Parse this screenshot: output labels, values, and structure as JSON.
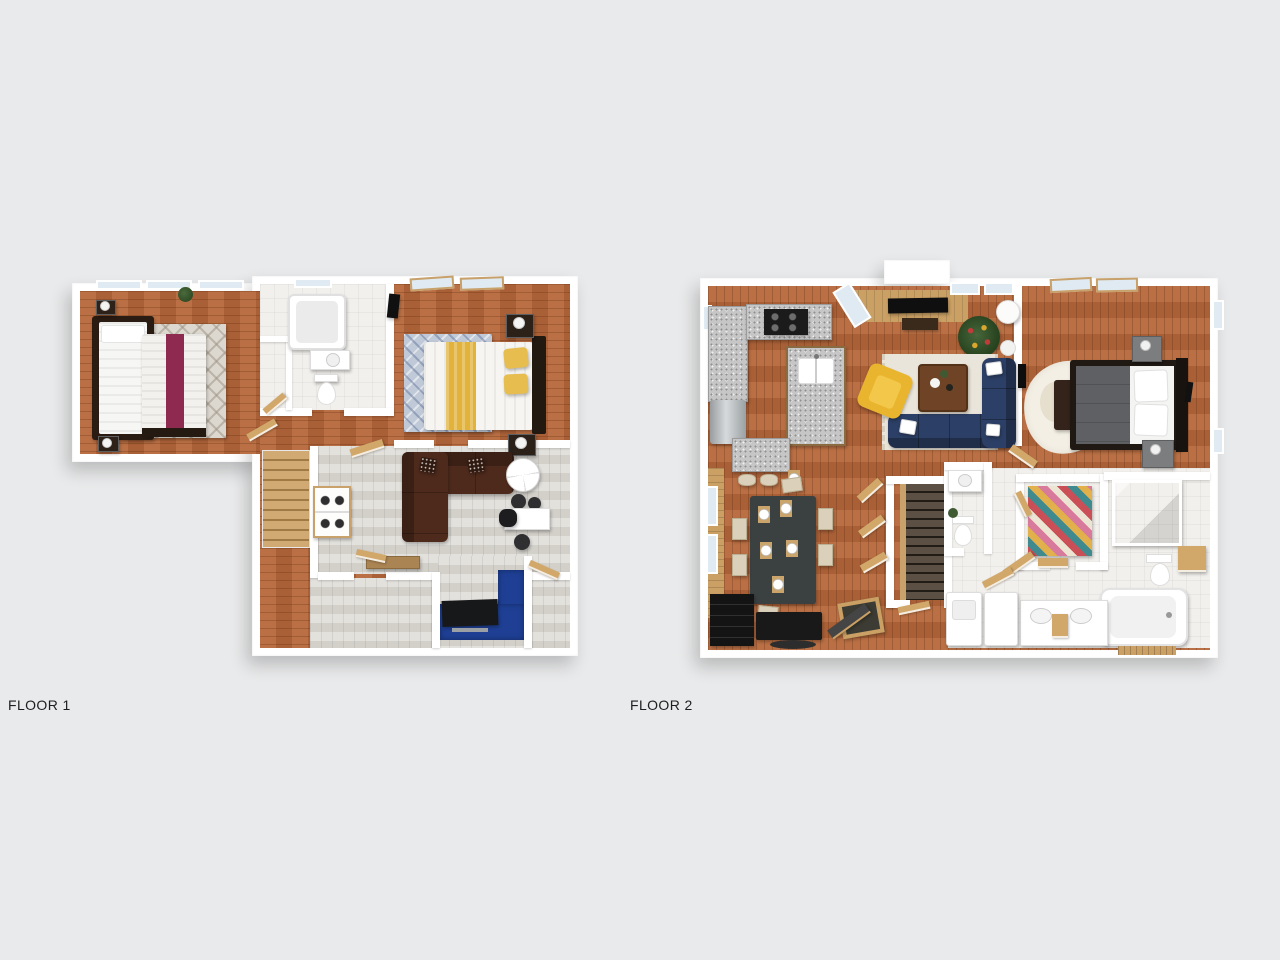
{
  "title_labels": {
    "floor1": "FLOOR 1",
    "floor2": "FLOOR 2"
  },
  "colors": {
    "bg": "#e9eaeb",
    "wall": "#ffffff",
    "wood": "#b4663a",
    "wood_light": "#dad7d1",
    "tile": "#f2f0ec",
    "granite": "#c6c6c6",
    "rug_gray": "#dcd8d0",
    "rug_blue": "#c0c9d7",
    "rug_royal": "#1e3f94",
    "rug_cream": "#eae5da",
    "maroon_bedding": "#8e2950",
    "yellow_bedding": "#e2b33a",
    "sofa_brown": "#4e2a1c",
    "sofa_navy": "#2c3f66",
    "chair_yellow": "#e9b52f",
    "glass": "#dfeaf2",
    "door_wood": "#d2a86a",
    "stair_wood": "#c9a26b",
    "tree_green": "#2d4a26",
    "table_dark": "#3b4041"
  }
}
